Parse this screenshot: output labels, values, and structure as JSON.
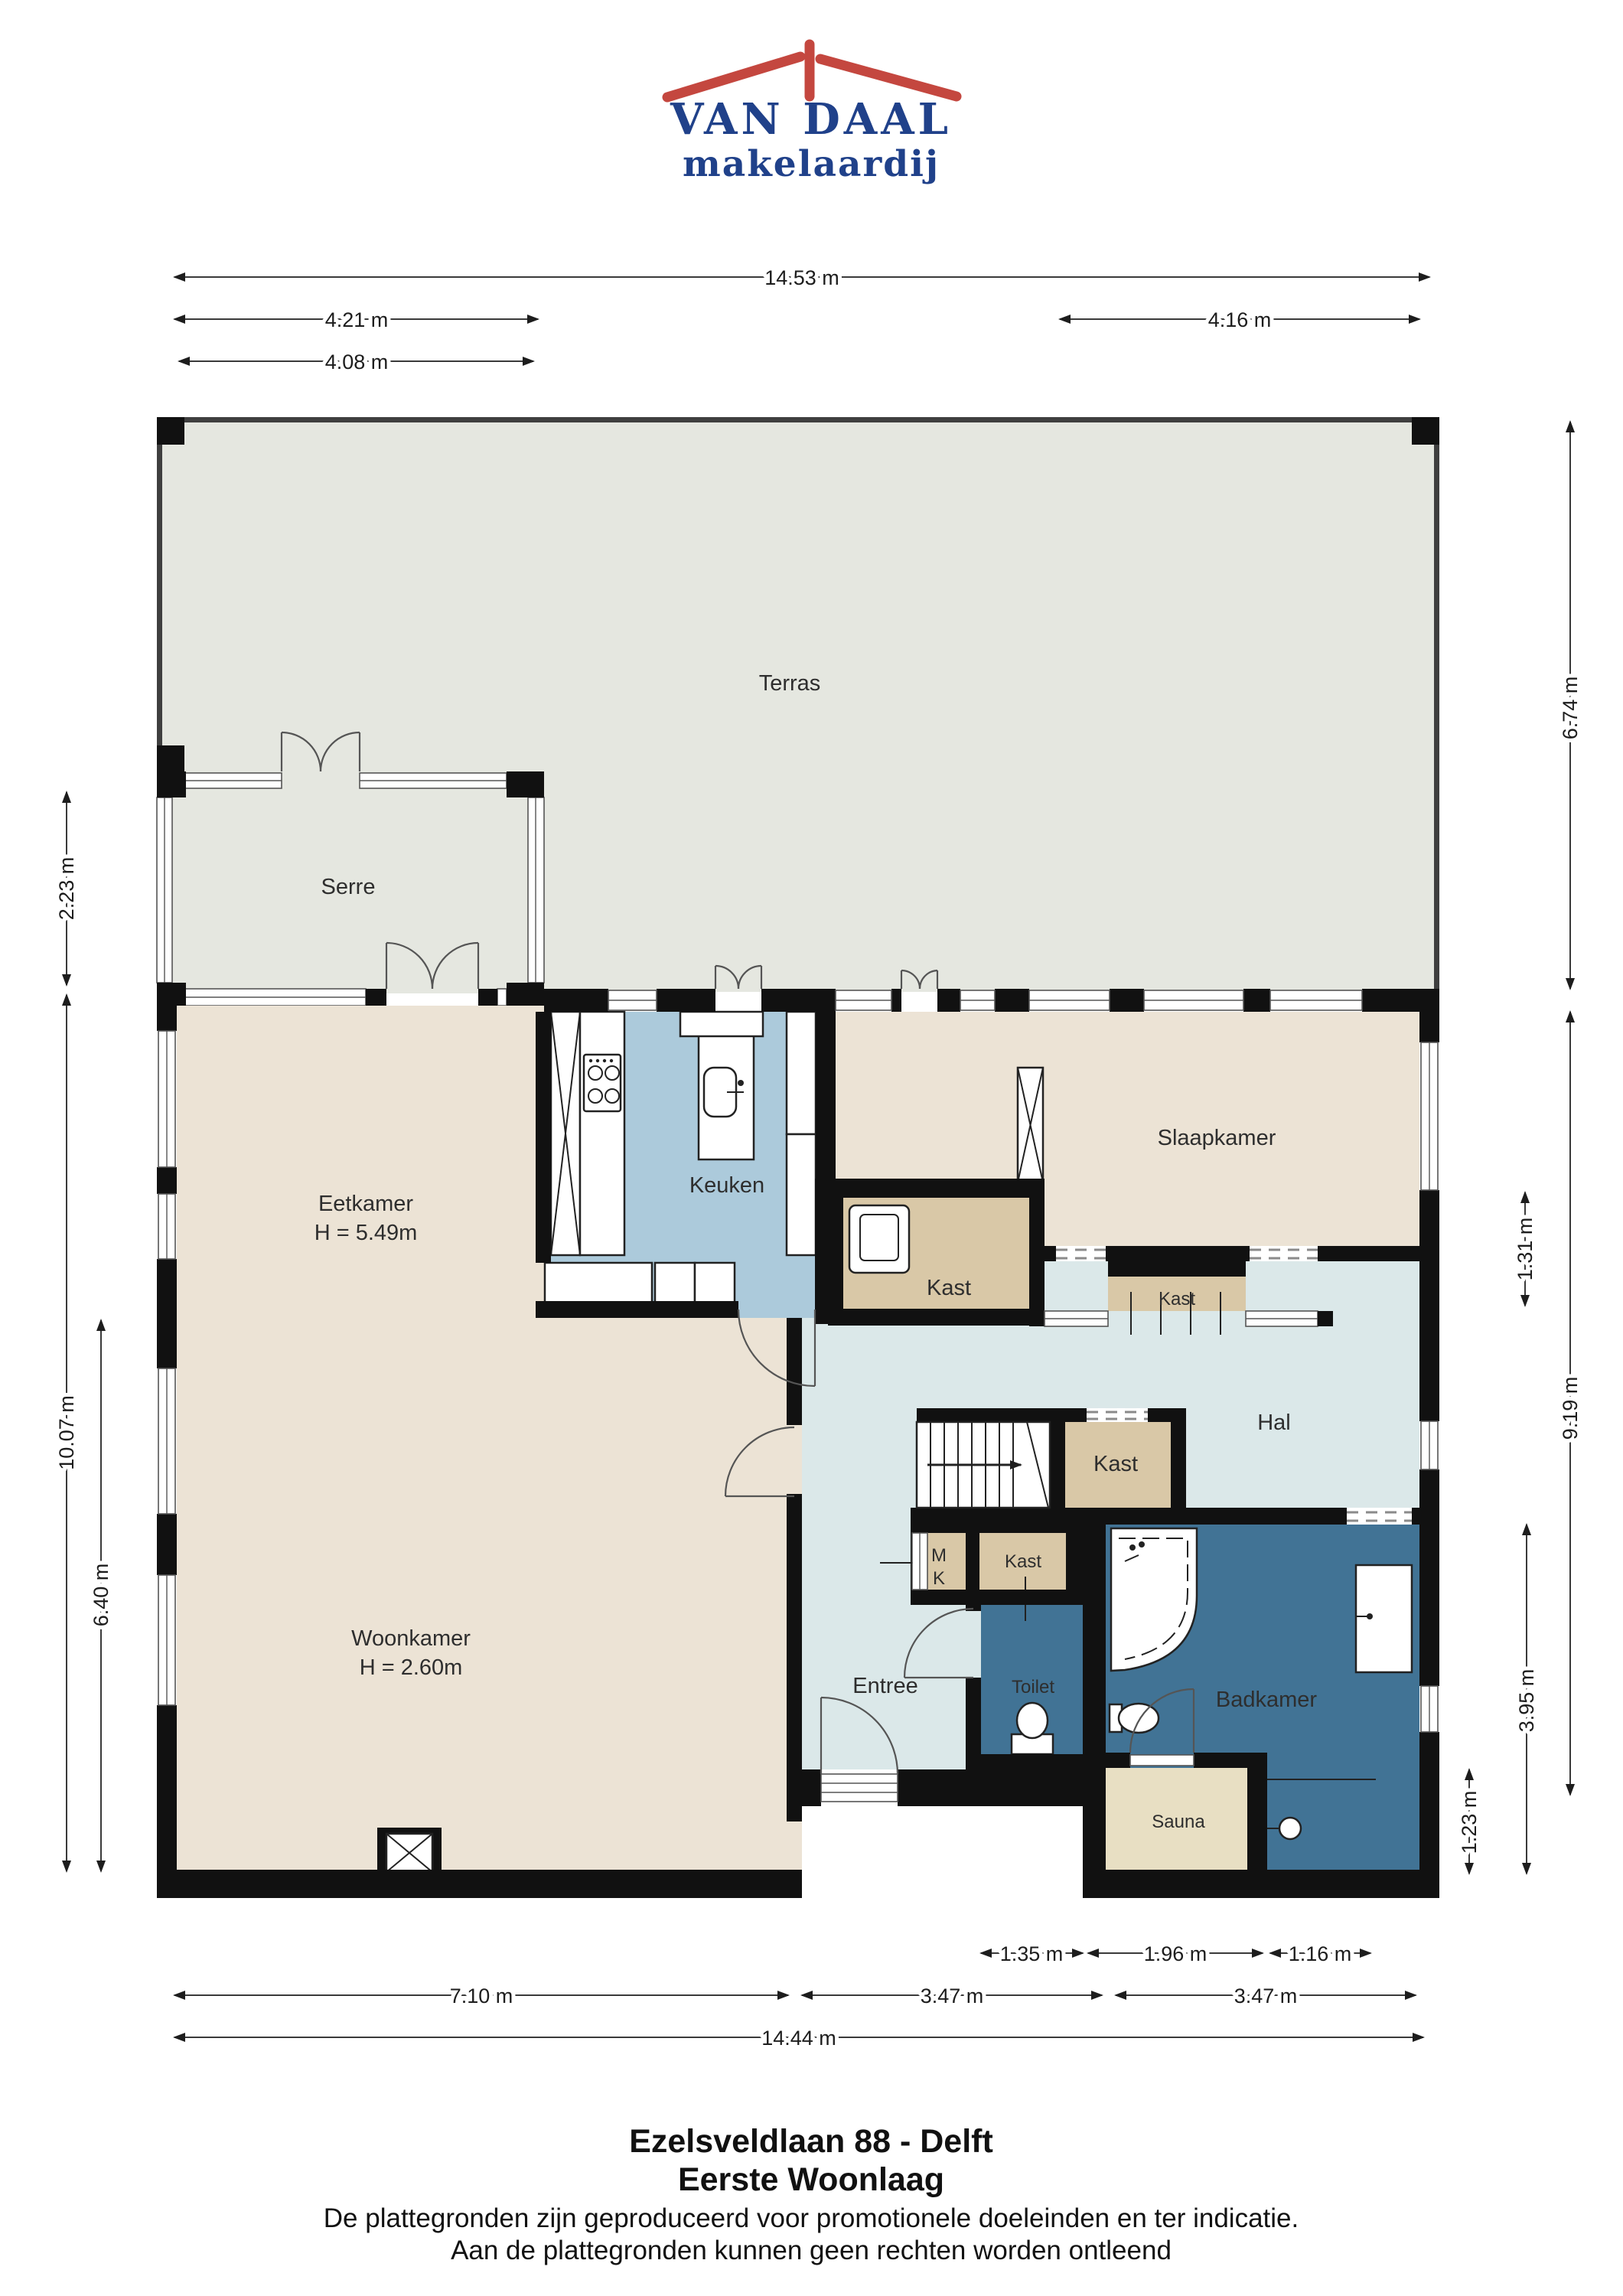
{
  "logo": {
    "name": "VAN DAAL",
    "tagline": "makelaardij"
  },
  "rooms": {
    "terras": {
      "label": "Terras"
    },
    "serre": {
      "label": "Serre"
    },
    "eetkamer": {
      "label": "Eetkamer",
      "height": "H = 5.49m"
    },
    "keuken": {
      "label": "Keuken"
    },
    "slaapkamer": {
      "label": "Slaapkamer"
    },
    "kast_keuken": {
      "label": "Kast"
    },
    "kast_slaapkamer": {
      "label": "Kast"
    },
    "kast_hal": {
      "label": "Kast"
    },
    "kast_entree": {
      "label": "Kast"
    },
    "meterkast": {
      "line1": "M",
      "line2": "K"
    },
    "hal": {
      "label": "Hal"
    },
    "woonkamer": {
      "label": "Woonkamer",
      "height": "H = 2.60m"
    },
    "entree": {
      "label": "Entree"
    },
    "toilet": {
      "label": "Toilet"
    },
    "badkamer": {
      "label": "Badkamer"
    },
    "sauna": {
      "label": "Sauna"
    }
  },
  "dimensions": {
    "top": [
      {
        "label": "14.53 m"
      },
      {
        "label": "4.21 m"
      },
      {
        "label": "4.16 m"
      },
      {
        "label": "4.08 m"
      }
    ],
    "left": [
      {
        "label": "2.23 m"
      },
      {
        "label": "10.07 m"
      },
      {
        "label": "6.40 m"
      }
    ],
    "right": [
      {
        "label": "6.74 m"
      },
      {
        "label": "1.31 m"
      },
      {
        "label": "9.19 m"
      },
      {
        "label": "3.95 m"
      },
      {
        "label": "1.23 m"
      }
    ],
    "bottom": [
      {
        "label": "1.35 m"
      },
      {
        "label": "1.96 m"
      },
      {
        "label": "1.16 m"
      },
      {
        "label": "7.10 m"
      },
      {
        "label": "3.47 m"
      },
      {
        "label": "3.47 m"
      },
      {
        "label": "14.44 m"
      }
    ]
  },
  "footer": {
    "title": "Ezelsveldlaan 88 - Delft",
    "subtitle": "Eerste Woonlaag",
    "disclaimer1": "De plattegronden zijn geproduceerd voor promotionele doeleinden en ter indicatie.",
    "disclaimer2": "Aan de plattegronden kunnen geen rechten worden ontleend"
  },
  "colors": {
    "wall": "#111111",
    "cream": "#ece3d5",
    "kitchen_blue": "#accadb",
    "hall_blue": "#dbe8e9",
    "closet_tan": "#d9c8a7",
    "sauna_tan": "#e8dfc3",
    "bath_blue": "#417395",
    "outdoor_gray": "#e5e7e0",
    "logo_blue": "#20418a",
    "logo_red": "#c4473f"
  }
}
